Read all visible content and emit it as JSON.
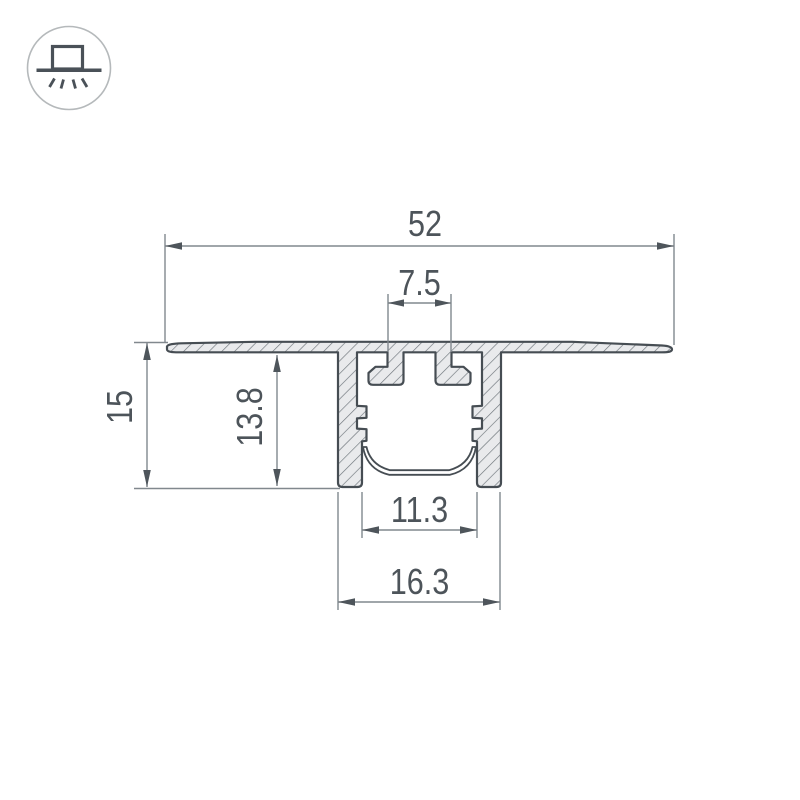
{
  "title": "Recessed LED aluminium profile cross-section drawing",
  "icon": {
    "name": "recessed-light-icon"
  },
  "colors": {
    "background": "#ffffff",
    "outline": "#464d53",
    "hatch_line": "#6d747a",
    "metal_fill": "#e9eaec",
    "dimension_line": "#81888e",
    "arrow": "#4e555b",
    "text": "#4d545a",
    "icon_dark": "#4a5158",
    "icon_circle": "#b5b9bb"
  },
  "dimensions": {
    "flange_width": "52",
    "clip_slot_width": "7.5",
    "total_depth": "15",
    "body_depth": "13.8",
    "inner_width": "11.3",
    "body_width": "16.3"
  }
}
